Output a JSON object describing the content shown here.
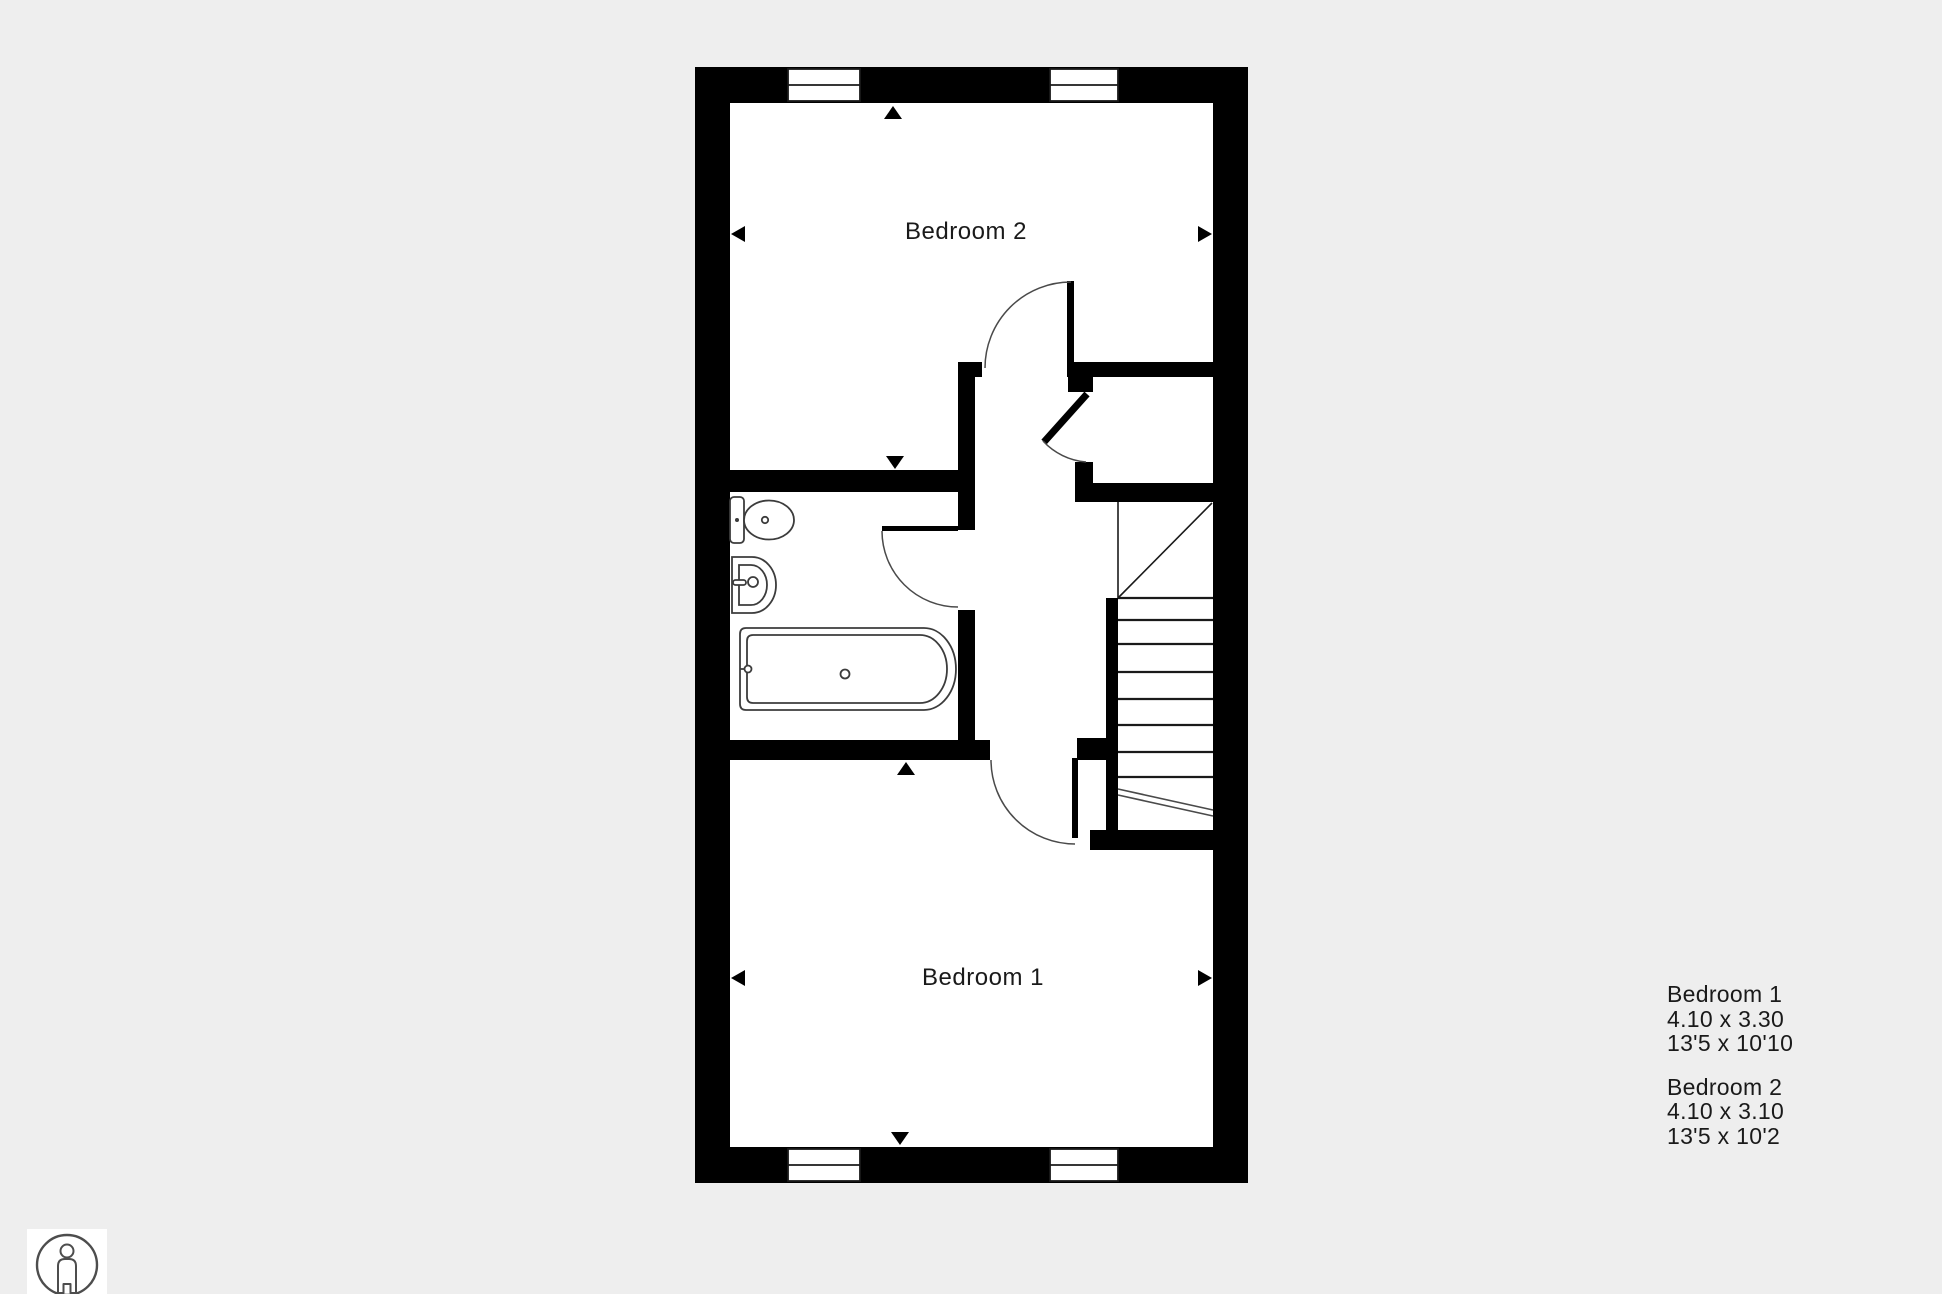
{
  "canvas": {
    "background": "#eeeeee",
    "plan_fill": "#ffffff",
    "wall_color": "#000000",
    "arc_color": "#4a4a4a",
    "fixture_color": "#3c3c3c",
    "text_color": "#1a1a1a"
  },
  "plan": {
    "rooms": [
      {
        "id": "bedroom-2",
        "label": "Bedroom 2"
      },
      {
        "id": "bedroom-1",
        "label": "Bedroom 1"
      }
    ],
    "features": [
      "bathroom",
      "stairs",
      "landing",
      "closet"
    ],
    "window_count": 4,
    "door_count": 4
  },
  "dimensions_panel": {
    "entries": [
      {
        "room": "Bedroom 1",
        "metric": "4.10 x 3.30",
        "imperial": "13'5 x 10'10"
      },
      {
        "room": "Bedroom 2",
        "metric": "4.10 x 3.10",
        "imperial": "13'5 x 10'2"
      }
    ]
  },
  "icons": {
    "scale_person": "person-in-circle"
  }
}
